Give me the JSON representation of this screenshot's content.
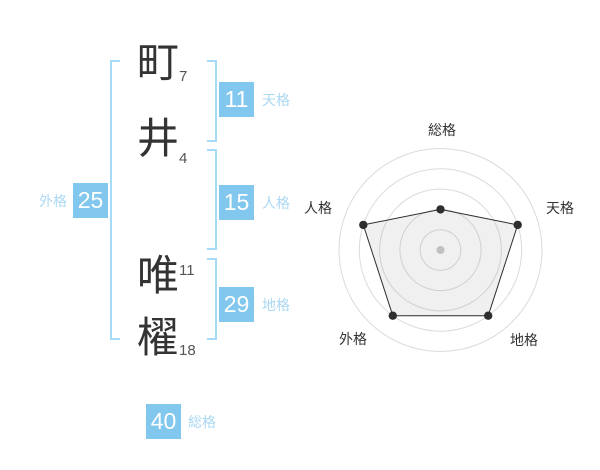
{
  "name_block": {
    "characters": [
      {
        "char": "町",
        "strokes": "7"
      },
      {
        "char": "井",
        "strokes": "4"
      },
      {
        "char": "唯",
        "strokes": "11"
      },
      {
        "char": "櫂",
        "strokes": "18"
      }
    ],
    "badges": {
      "tenkaku": {
        "value": "11",
        "label": "天格"
      },
      "jinkaku": {
        "value": "15",
        "label": "人格"
      },
      "chikaku": {
        "value": "29",
        "label": "地格"
      },
      "gaikaku": {
        "value": "25",
        "label": "外格"
      },
      "soukaku": {
        "value": "40",
        "label": "総格"
      }
    },
    "colors": {
      "badge_blue": "#82c7ee",
      "label_blue": "#abd8f3",
      "bracket_blue": "#a6dbf7",
      "kanji_dark": "#333333",
      "stroke_gray": "#555555"
    }
  },
  "chart_data": {
    "type": "radar",
    "axes": [
      "総格",
      "天格",
      "地格",
      "外格",
      "人格"
    ],
    "series": [
      {
        "name": "運勢スコア",
        "values": [
          40,
          80,
          80,
          80,
          80
        ]
      }
    ],
    "scale_max": 100,
    "rings": [
      20,
      40,
      60,
      80,
      100
    ],
    "grid": "circular-no-spokes",
    "legend": "none",
    "colors": {
      "grid_line": "#dbdbdb",
      "polygon_stroke": "#2e2e2e",
      "polygon_fill": "rgba(140,140,140,0.13)",
      "point": "#2e2e2e",
      "center_dot": "#c8c8c8",
      "axis_label": "#333333"
    }
  }
}
